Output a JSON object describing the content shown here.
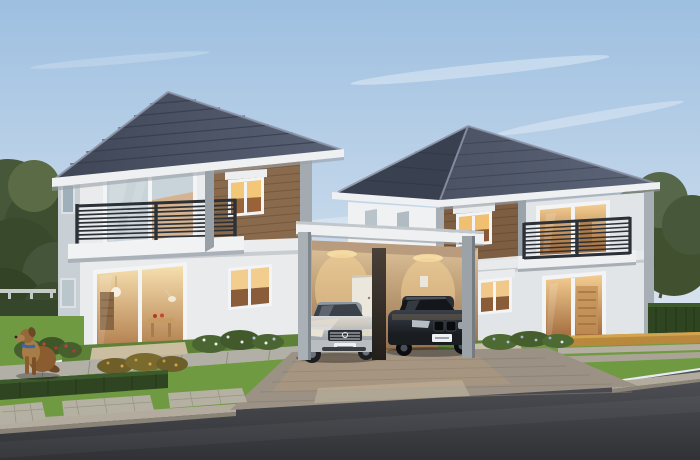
{
  "scene": {
    "type": "architectural-render",
    "description": "Dusk 3D rendering of two modern two-storey detached houses joined by a shared flat-roof double carport holding a silver sedan and a black sedan. Warm light glows from the windows and carport. Landscaped lawn, trimmed hedges, flowering shrubs, concrete paver pads and a kerbed asphalt road fill the foreground; a golden dog with a blue collar sits on the left walkway. Trees and a tall green hedge frame both sides under a pale blue sky with wispy clouds.",
    "left_house": {
      "storeys": 2,
      "roof": "hip roof, dark grey concrete tile",
      "facade": "white-grey render with brown wood-panel accent",
      "features": [
        "balcony with dark slat railing",
        "large upper window",
        "lit accent window",
        "sliding glass door to warm-lit dining room",
        "side windows"
      ]
    },
    "right_house": {
      "storeys": 2,
      "roof": "hip roof, dark grey concrete tile",
      "facade": "white-grey render with brown wood-panel accent",
      "features": [
        "balcony with dark slat railing",
        "lit wood-panel window",
        "warm-lit upper glass doors",
        "warm-lit entry glass door",
        "two small side windows"
      ]
    },
    "carport": {
      "structure": "flat white canopy on grey and dark timber posts",
      "vehicles": [
        "silver luxury sedan with white plate",
        "black luxury sedan with white plate"
      ],
      "interior": "warm beige wall with white door and downlight pools"
    },
    "foreground": [
      "green lawn",
      "dark trimmed hedge rows",
      "red, gold, white and blue flowering shrubs",
      "concrete walkway and paver pads",
      "brick-paver driveway",
      "concrete kerb",
      "asphalt road",
      "sitting golden dog with blue collar"
    ],
    "sky": "pale blue gradient with thin cirrus clouds"
  },
  "colors": {
    "sky_top": "#9dbfe0",
    "sky_mid": "#c2d6ea",
    "sky_horizon": "#e4ebf1",
    "cloud_white": "#ffffff",
    "roof_dark": "#3f4656",
    "roof_light": "#596175",
    "roof_ridge": "#8d95a8",
    "fascia": "#eef0f1",
    "wall_white": "#e9ebec",
    "wall_bright": "#eff1f2",
    "wall_cool": "#e2e5e8",
    "wall_shade": "#c9d0d5",
    "trim": "#a3abb1",
    "wood": "#8a6a4c",
    "wood_dark": "#7d5e42",
    "railing": "#2c3137",
    "window_frame": "#f3f4f5",
    "glass_cool": "#c9d4da",
    "glass_warm": "#e3b072",
    "interior_glow": "#f6dca6",
    "interior_deep": "#8a5a34",
    "carport_wall": "#d2b68c",
    "carport_ceiling": "#b99c7d",
    "door_white": "#ece7dc",
    "grass": "#6f9a42",
    "grass_dark": "#5d8136",
    "hedge": "#2f4521",
    "shrub_gold": "#b8893c",
    "foliage": "#4d5f3b",
    "foliage_dark": "#394a2c",
    "walkway": "#b2afa6",
    "paver_pad": "#b4b0a2",
    "driveway": "#9b9184",
    "curb": "#b3ac9e",
    "road_light": "#505257",
    "road_dark": "#303236",
    "car_silver": "#c6cbcf",
    "car_black": "#15181c",
    "plate": "#eef1f3",
    "dog": "#8a5c30",
    "dog_light": "#a87c46",
    "collar": "#3a66a8"
  }
}
